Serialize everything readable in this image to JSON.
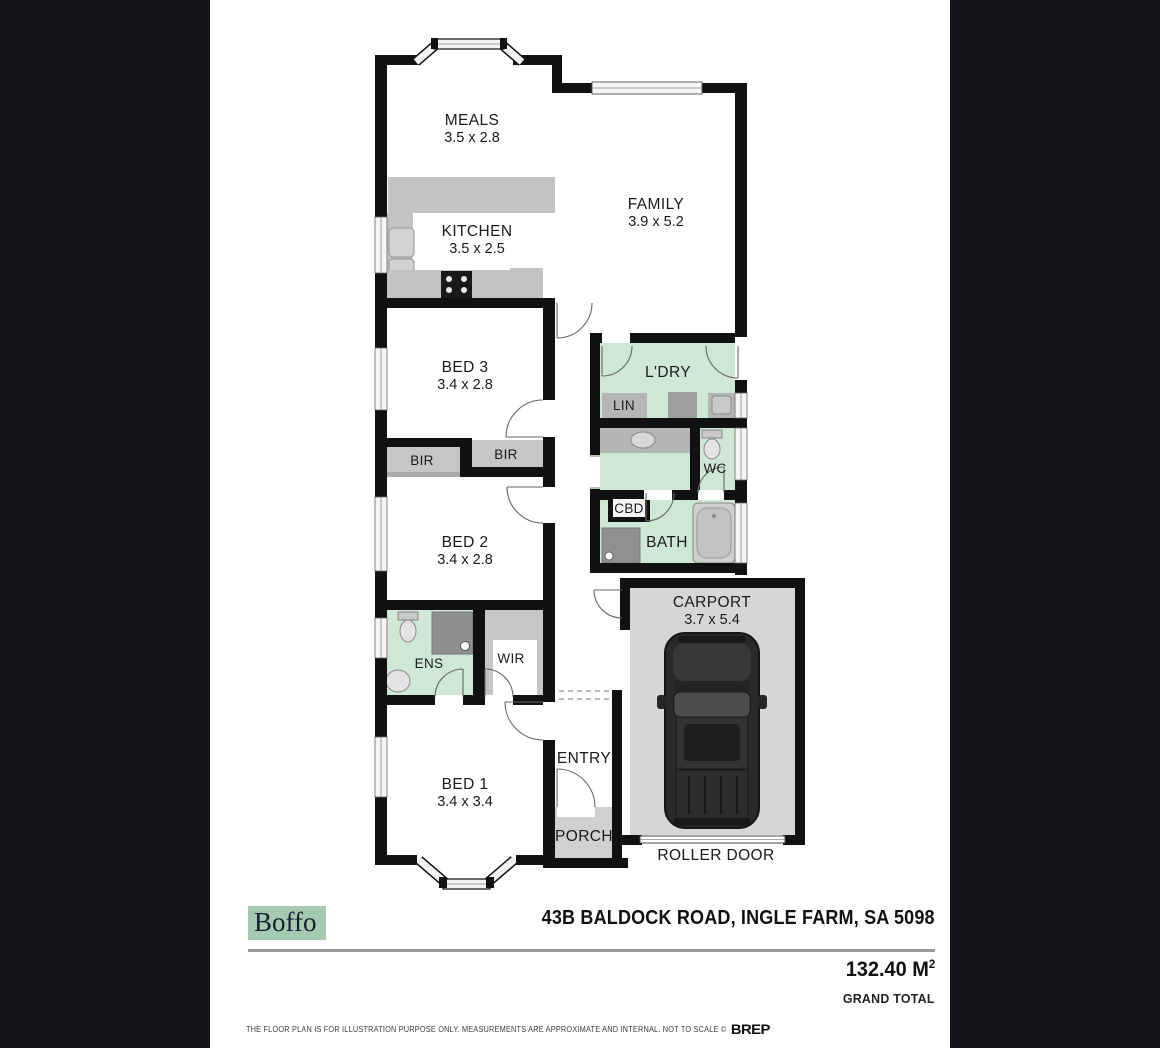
{
  "plan": {
    "rooms": {
      "meals": {
        "label": "MEALS",
        "dims": "3.5 x 2.8"
      },
      "family": {
        "label": "FAMILY",
        "dims": "3.9 x 5.2"
      },
      "kitchen": {
        "label": "KITCHEN",
        "dims": "3.5 x 2.5"
      },
      "bed3": {
        "label": "BED 3",
        "dims": "3.4 x 2.8"
      },
      "bed2": {
        "label": "BED 2",
        "dims": "3.4 x 2.8"
      },
      "bed1": {
        "label": "BED 1",
        "dims": "3.4 x 3.4"
      },
      "laundry": {
        "label": "L'DRY"
      },
      "lin": {
        "label": "LIN"
      },
      "bir_left": {
        "label": "BIR"
      },
      "bir_right": {
        "label": "BIR"
      },
      "wc": {
        "label": "WC"
      },
      "cbd": {
        "label": "CBD"
      },
      "bath": {
        "label": "BATH"
      },
      "ens": {
        "label": "ENS"
      },
      "wir": {
        "label": "WIR"
      },
      "entry": {
        "label": "ENTRY"
      },
      "porch": {
        "label": "PORCH"
      },
      "carport": {
        "label": "CARPORT",
        "dims": "3.7 x 5.4"
      },
      "roller_door": {
        "label": "ROLLER DOOR"
      }
    }
  },
  "footer": {
    "brand": "Boffo",
    "address": "43B BALDOCK ROAD, INGLE FARM, SA 5098",
    "area_value": "132.40 M",
    "area_superscript": "2",
    "area_label": "GRAND TOTAL",
    "disclaimer": "THE FLOOR PLAN IS FOR ILLUSTRATION PURPOSE ONLY. MEASUREMENTS ARE APPROXIMATE AND INTERNAL. NOT TO SCALE ©",
    "provider_logo": "BREP"
  },
  "colors": {
    "side_panel": "#15151c",
    "wall": "#111111",
    "wet_area_green": "#cfe8d6",
    "fixture_gray": "#b5b5b5",
    "floor_gray": "#d6d6d6",
    "brand_bg": "#a5c9b1"
  }
}
